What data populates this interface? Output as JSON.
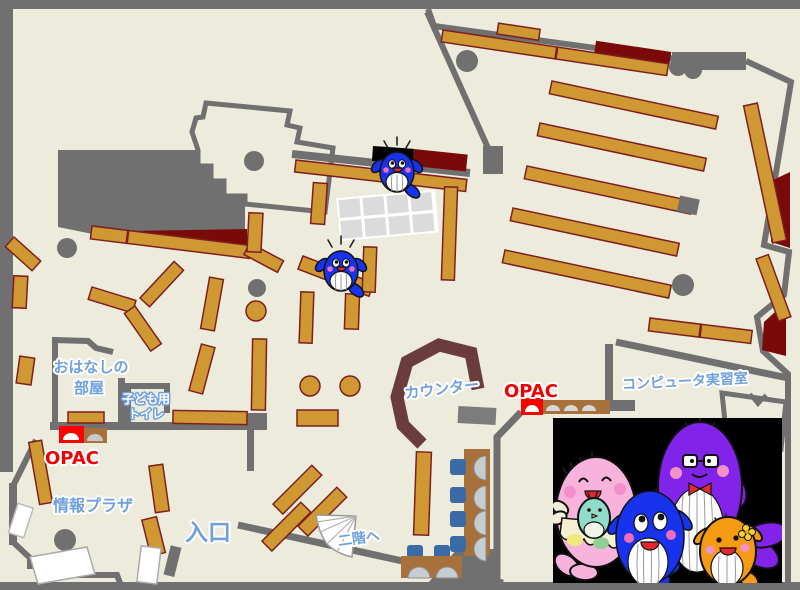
{
  "labels": {
    "storytelling": {
      "line1": "おはなしの",
      "line2": "部屋"
    },
    "kids_toilet": {
      "line1": "子ども用",
      "line2": "トイレ"
    },
    "opac_left": "OPAC",
    "opac_right": "OPAC",
    "info_plaza": "情報プラザ",
    "entrance": "入口",
    "counter": "カウンター",
    "computer_room": "コンピュータ実習室",
    "to_second_floor": "二階へ"
  },
  "colors": {
    "floor": "#EDEBDC",
    "wall_gray": "#707070",
    "shelf_gold": "#CF9832",
    "shelf_border": "#7E1F1F",
    "dark_red": "#7A0A0A",
    "counter_brown": "#6B3C3C",
    "opac_red": "#EE0000",
    "label_blue": "#6FA0DF",
    "chair_blue": "#3A6BA5",
    "table_brown": "#A8703A",
    "mascot_blue": "#1733EE",
    "mascot_pink": "#F7B3DB",
    "mascot_purple": "#8223E9",
    "mascot_orange": "#F49B13"
  }
}
